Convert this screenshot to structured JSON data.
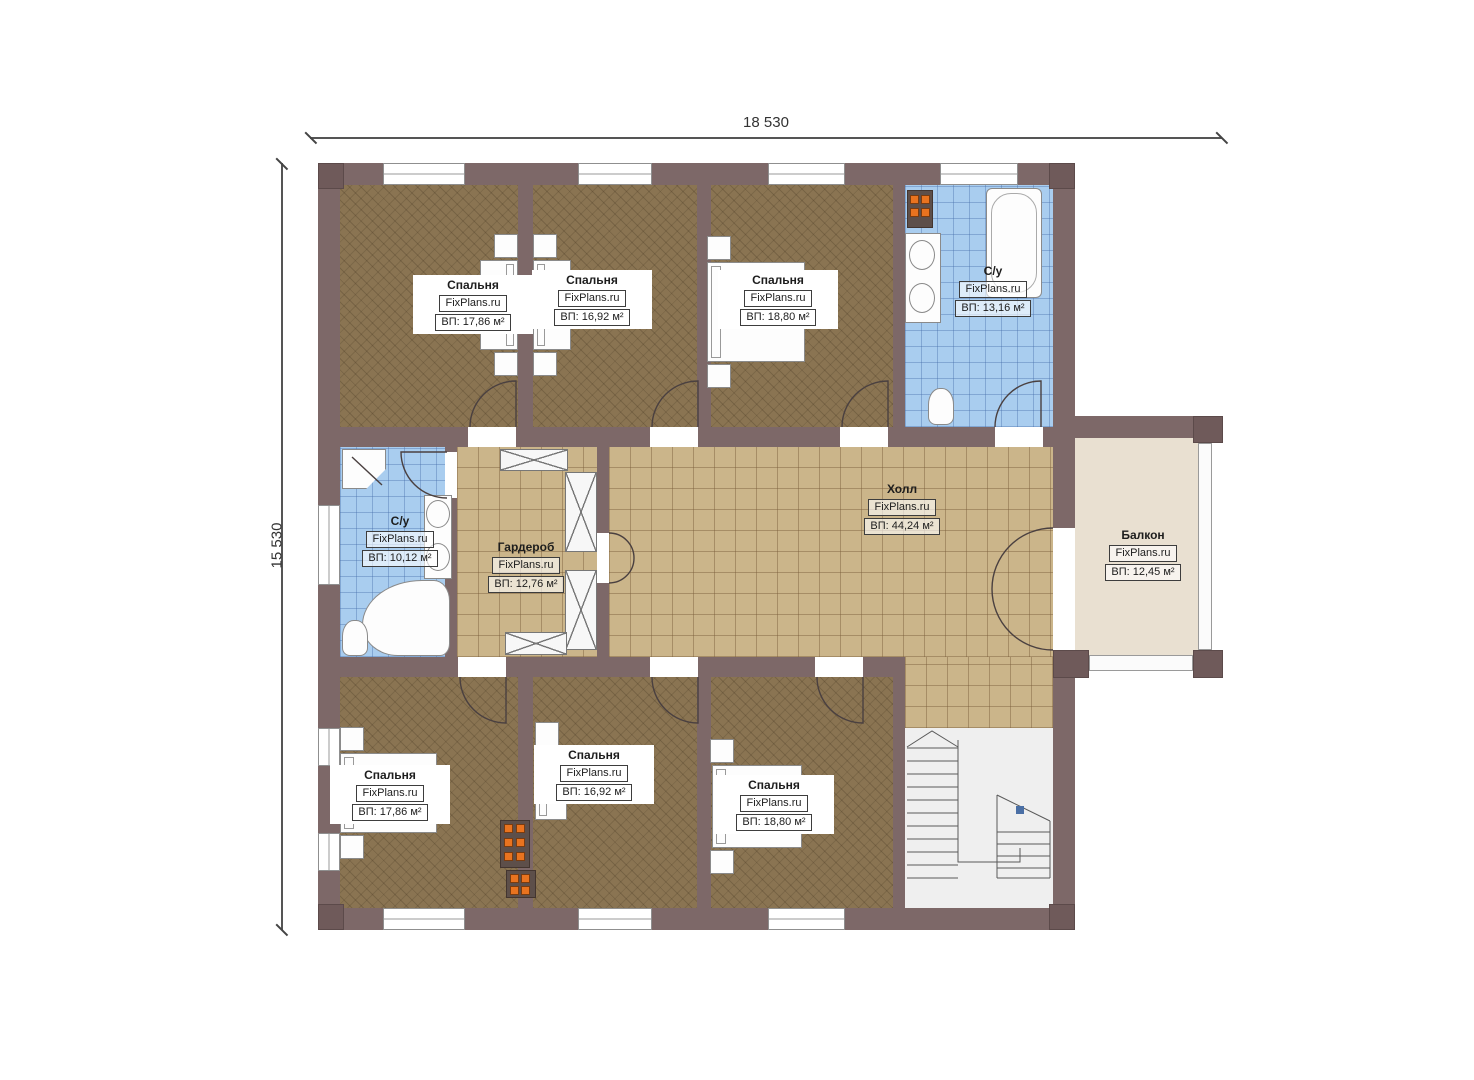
{
  "dimensions": {
    "width": "18 530",
    "height": "15 530"
  },
  "rooms": [
    {
      "id": "bedroom-top-left",
      "name": "Спальня",
      "brand": "FixPlans.ru",
      "area": "ВП: 17,86 м²"
    },
    {
      "id": "bedroom-top-middle",
      "name": "Спальня",
      "brand": "FixPlans.ru",
      "area": "ВП: 16,92 м²"
    },
    {
      "id": "bedroom-top-right",
      "name": "Спальня",
      "brand": "FixPlans.ru",
      "area": "ВП: 18,80 м²"
    },
    {
      "id": "bathroom-top-right",
      "name": "С/у",
      "brand": "FixPlans.ru",
      "area": "ВП: 13,16 м²"
    },
    {
      "id": "bathroom-middle-left",
      "name": "С/у",
      "brand": "FixPlans.ru",
      "area": "ВП: 10,12 м²"
    },
    {
      "id": "wardrobe",
      "name": "Гардероб",
      "brand": "FixPlans.ru",
      "area": "ВП: 12,76 м²"
    },
    {
      "id": "hall",
      "name": "Холл",
      "brand": "FixPlans.ru",
      "area": "ВП: 44,24 м²"
    },
    {
      "id": "balcony",
      "name": "Балкон",
      "brand": "FixPlans.ru",
      "area": "ВП: 12,45 м²"
    },
    {
      "id": "bedroom-bottom-left",
      "name": "Спальня",
      "brand": "FixPlans.ru",
      "area": "ВП: 17,86 м²"
    },
    {
      "id": "bedroom-bottom-middle",
      "name": "Спальня",
      "brand": "FixPlans.ru",
      "area": "ВП: 16,92 м²"
    },
    {
      "id": "bedroom-bottom-right",
      "name": "Спальня",
      "brand": "FixPlans.ru",
      "area": "ВП: 18,80 м²"
    }
  ],
  "colors": {
    "wall": "#7d6868",
    "bedroom_floor": "#8a7452",
    "hall_tile": "#cbb58a",
    "bath_tile": "#a9cdef",
    "balcony_floor": "#e9e0d1",
    "flue_orange": "#e9731f"
  }
}
